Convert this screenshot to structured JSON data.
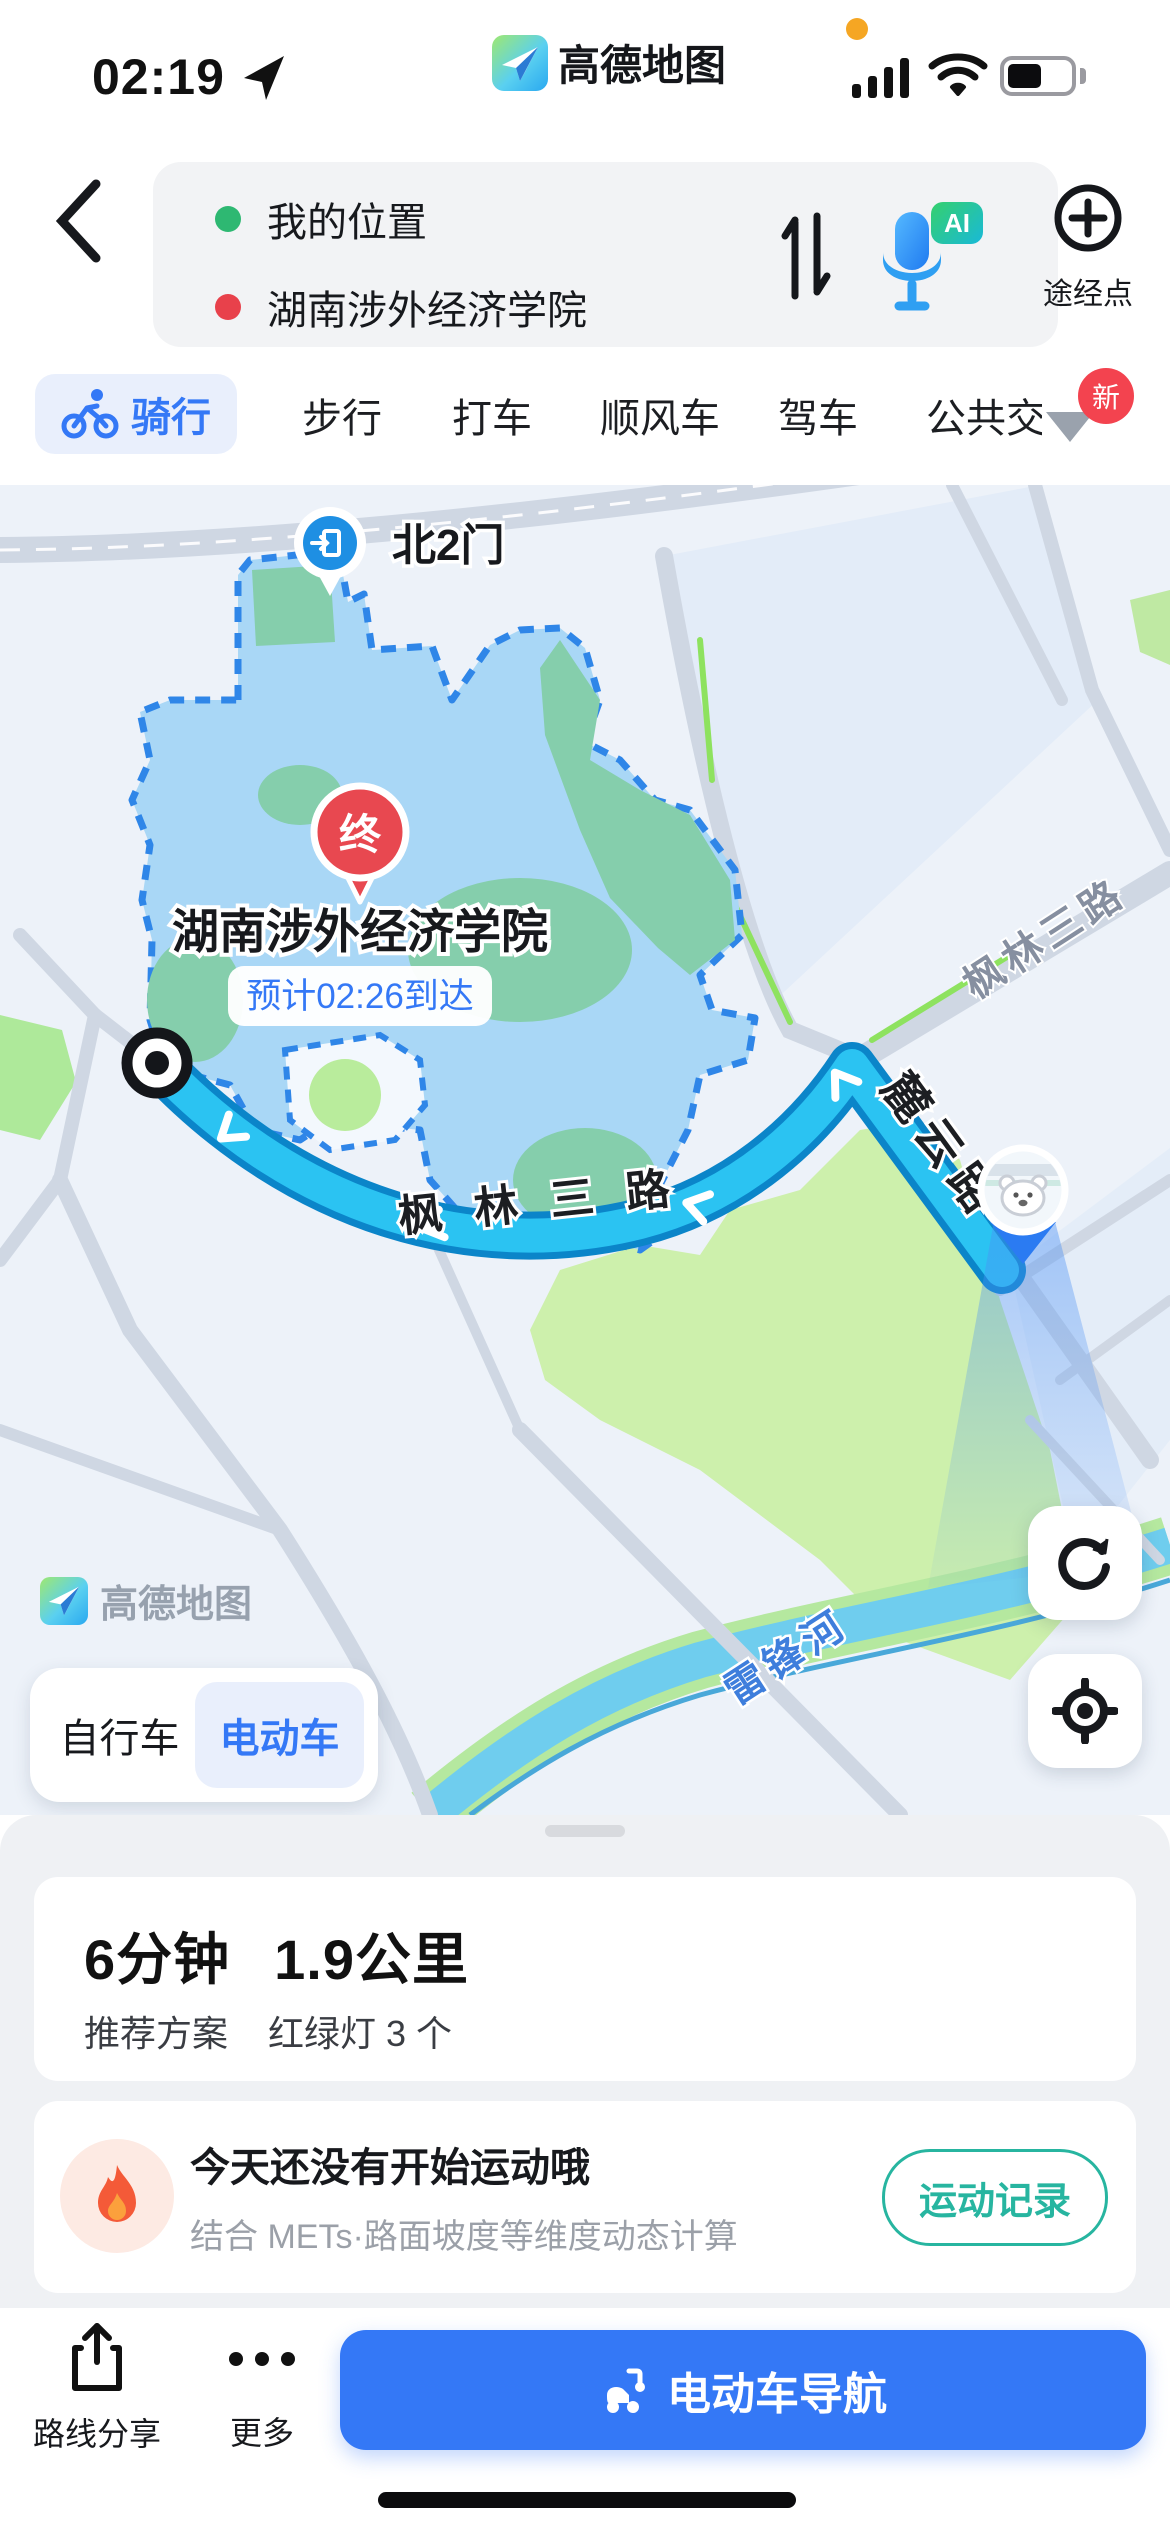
{
  "status_bar": {
    "time": "02:19",
    "brand": "高德地图",
    "recording_dot_color": "#F5A623"
  },
  "search": {
    "from": "我的位置",
    "to": "湖南涉外经济学院",
    "via_button": "途经点",
    "ai_badge": "AI",
    "from_dot_color": "#2EB872",
    "to_dot_color": "#E8414B"
  },
  "tabs": {
    "items": [
      {
        "label": "骑行",
        "selected": true
      },
      {
        "label": "步行",
        "selected": false
      },
      {
        "label": "打车",
        "selected": false
      },
      {
        "label": "顺风车",
        "selected": false
      },
      {
        "label": "驾车",
        "selected": false
      },
      {
        "label": "公共交",
        "selected": false
      }
    ],
    "new_badge": "新"
  },
  "map": {
    "labels": {
      "gate": "北2门",
      "destination": "湖南涉外经济学院",
      "eta": "预计02:26到达",
      "end_marker": "终",
      "route_road": "枫 林 三 路",
      "east_road": "枫林三路",
      "side_road": "麓云路",
      "river": "雷锋河",
      "watermark": "高德地图"
    },
    "colors": {
      "route_fill": "#2BC3F2",
      "route_border": "#0B85C9",
      "campus_fill": "#A9D7F6",
      "campus_border": "#2F86E8",
      "park_green": "#CDF0AC",
      "river_blue": "#6FCDEE"
    }
  },
  "vehicle_toggle": {
    "options": [
      "自行车",
      "电动车"
    ],
    "selected": "电动车"
  },
  "route_summary": {
    "duration": "6分钟",
    "distance": "1.9公里",
    "plan": "推荐方案",
    "traffic_lights": "红绿灯 3 个"
  },
  "sport_card": {
    "title": "今天还没有开始运动哦",
    "subtitle": "结合 METs·路面坡度等维度动态计算",
    "button": "运动记录"
  },
  "footer": {
    "share": "路线分享",
    "more": "更多",
    "navigate": "电动车导航"
  }
}
